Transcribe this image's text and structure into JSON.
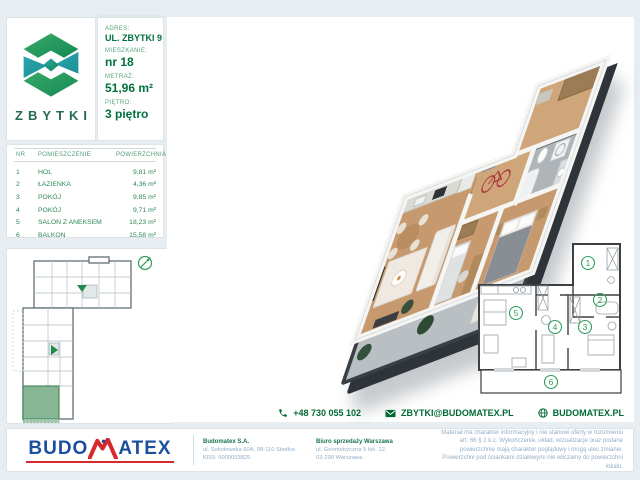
{
  "card": {
    "tab": "Z9.18"
  },
  "brand": {
    "name": "ZBYTKI"
  },
  "details": {
    "address_label": "ADRES:",
    "address": "UL. ZBYTKI 9",
    "apartment_label": "MIESZKANIE:",
    "apartment": "nr 18",
    "area_label": "METRAŻ:",
    "area": "51,96 m²",
    "floor_label": "PIĘTRO:",
    "floor": "3 piętro"
  },
  "rooms_table": {
    "headers": [
      "NR",
      "POMIESZCZENIE",
      "POWIERZCHNIA"
    ],
    "rows": [
      {
        "nr": "1",
        "name": "HOL",
        "area": "9,81 m²"
      },
      {
        "nr": "2",
        "name": "ŁAZIENKA",
        "area": "4,36 m²"
      },
      {
        "nr": "3",
        "name": "POKÓJ",
        "area": "9,85 m²"
      },
      {
        "nr": "4",
        "name": "POKÓJ",
        "area": "9,71 m²"
      },
      {
        "nr": "5",
        "name": "SALON Z ANEKSEM",
        "area": "18,23 m²"
      },
      {
        "nr": "6",
        "name": "BALKON",
        "area": "15,58 m²"
      }
    ]
  },
  "plan_markers": [
    "1",
    "2",
    "3",
    "4",
    "5",
    "6"
  ],
  "contact": {
    "phone": "+48 730 055 102",
    "email": "ZBYTKI@BUDOMATEX.PL",
    "website": "BUDOMATEX.PL"
  },
  "footer": {
    "logo_text_1": "BUDO",
    "logo_text_2": "ATEX",
    "company": {
      "name": "Budomatex S.A.",
      "address": "ul. Sokołowska 60A, 08-110 Siedlce",
      "krs": "KRS: 0000093825"
    },
    "office": {
      "name": "Biuro sprzedaży Warszawa",
      "address_line1": "ul. Geometryczna 5 lok. 12,",
      "address_line2": "03-290 Warszawa"
    },
    "disclaimer": "Materiał ma charakter informacyjny i nie stanowi oferty w rozumieniu art. 66 § 1 k.c. Wykończenie, układ, wizualizacje oraz podane powierzchnie mają charakter poglądowy i mogą ulec zmianie. Powierzchni pod ściankami działowymi nie wliczamy do powierzchni lokalu."
  },
  "colors": {
    "brand_green": "#00713e",
    "label_green": "#4f9d74",
    "marker_green": "#2f9e5a",
    "logo_blue": "#1c4f9e",
    "logo_red": "#d7282e",
    "muted_blue": "#92aec8"
  }
}
